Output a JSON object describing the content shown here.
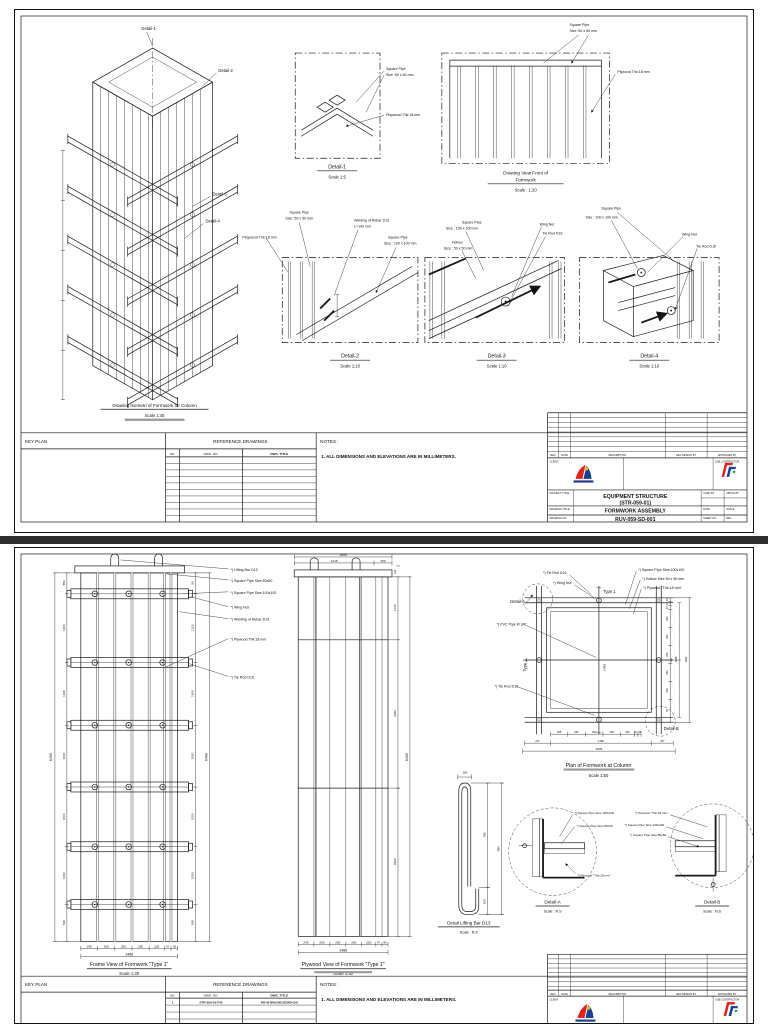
{
  "colors": {
    "red": "#e2231a",
    "blue": "#1b3f94",
    "yellow": "#f5c400",
    "green": "#00a650"
  },
  "s1": {
    "iso": {
      "c1": "Detail-1",
      "c2": "Detail-2",
      "c3": "Detail-3",
      "c4": "Detail-4",
      "cap": "Drawing Isometri of Formwork for Column",
      "scale": "Scale 1:40"
    },
    "d1": {
      "l1": "Square Pipe",
      "l2": "Size :50 x 50 mm",
      "l3": "Playwood Thk:18 mm",
      "t": "Detail-1",
      "s": "Scale 1:5"
    },
    "fv": {
      "l1": "Square Pipe",
      "l2": "Size :50 x 50 mm",
      "l3": "Plywood Thk:18 mm",
      "t1": "Drawing View Front of",
      "t2": "Formwork",
      "s": "Scale : 1:20"
    },
    "d2": {
      "l1": "Square Pipe",
      "l2": "Size :50 x 50 mm",
      "l3": "Playwood Thk:18 mm",
      "l4": "Welding of Rebar D13",
      "l5": "L=100 mm",
      "l6": "Square Pipe",
      "l7": "Size : 100 x 100 mm",
      "t": "Detail-2",
      "s": "Scale 1:10"
    },
    "d3": {
      "l1": "Square Pipe",
      "l2": "Size : 100 x 100 mm",
      "l3": "Hollow",
      "l4": "Size : 50 x 50 mm",
      "l5": "Wing Nut",
      "l6": "Tie Rod D16",
      "t": "Detail-3",
      "s": "Scale 1:10"
    },
    "d4": {
      "l1": "Square Pipe",
      "l2": "Size : 100 x 100 mm",
      "l3": "Wing Nut",
      "l4": "Tie Rod D16",
      "t": "Detail-4",
      "s": "Scale 1:10"
    },
    "strip": {
      "key": "KEY PLAN",
      "ref": "REFERENCE DRAWINGS",
      "no": "NO.",
      "dno": "DWG. NO.",
      "dtitle": "DWG. TITLE",
      "notes": "NOTES :",
      "note1": "1. ALL DIMENSIONS AND ELEVATIONS ARE IN MILLIMETERS."
    },
    "tb": {
      "rev": "REV",
      "date": "DATE",
      "desc": "DESCRIPTION",
      "rdb": "REV DESIGN BY",
      "apb": "APPROVED BY",
      "client": "CLIENT",
      "sub": "SUB CONTRACTOR",
      "ptl": "PROJECT TITLE",
      "pt1": "EQUIPMENT STRUCTURE",
      "pt2": "(STR-059-01)",
      "dtl": "DRAWING TITLE",
      "dt": "FORMWORK ASSEMBLY",
      "dnl": "DRAWING NO",
      "dn": "RUV-059-SD-001",
      "chk": "CHKD BY",
      "app": "APPVD BY",
      "datel": "DATE",
      "scl": "SCALE",
      "shl": "SHEET NO",
      "revl": "REV"
    }
  },
  "s2": {
    "lab": {
      "a": "*) Lifting Bar D13",
      "b": "*) Square Pipe Size:50x50",
      "c": "*) Square Pipe Size:100x100",
      "d": "*) Wing Nut",
      "e": "*) Welding of Rebar D13",
      "f": "*) Plywood Thk:18 mm",
      "g": "*) Tie Rod D16"
    },
    "fr": {
      "cap": "Frame View of Formwork \"Type 1\"",
      "s": "Scale 1:30",
      "bt": "1488",
      "lt": "6400",
      "rt": "6400",
      "bd": [
        "245",
        "250",
        "250",
        "250",
        "220",
        "97",
        "96"
      ],
      "ld": [
        "550",
        "1200",
        "1000",
        "1000",
        "1000",
        "1000",
        "500"
      ],
      "rd": [
        "90",
        "1100",
        "1000",
        "1000",
        "1000",
        "1000",
        "500"
      ]
    },
    "pw": {
      "cap": "Plywood View of Formwork \"Type 1\"",
      "s": "Scale 1:30",
      "tt": "1500",
      "td1": "1225",
      "td2": "250",
      "tsm": "140",
      "rt": "6400",
      "bt": "1488",
      "rd": [
        "1120",
        "2640",
        "2640"
      ],
      "bd": [
        "245",
        "250",
        "250",
        "250",
        "220",
        "97",
        "96"
      ]
    },
    "pl": {
      "cap": "Plan of Formwork at Column",
      "s": "Scale 1:50",
      "tie": "*) Tie Rod D16",
      "wing": "*) Wing Nut",
      "t1": "Type 1",
      "pipe": "*) Square Pipe Size:100x100",
      "hol": "*) Hollow Size 50 x 50 mm",
      "ply": "*) Plywood \"Thk:18 mm\"",
      "da": "Detail-A",
      "pvc": "*) PVC  Pipe Ø 3/4\"",
      "t2": "Type 2",
      "tie2": "*) Tie Rod D16",
      "db": "Detail-B",
      "bt": "2005",
      "rt1": "1488",
      "rt2": "1962",
      "inner": "1488",
      "bd": [
        "245",
        "250",
        "250",
        "250",
        "202",
        "45",
        "45"
      ],
      "b2": [
        "237",
        "1488",
        "237"
      ],
      "rd": [
        "50",
        "23",
        "23",
        "250",
        "250",
        "250",
        "250",
        "250",
        "50"
      ]
    },
    "lb": {
      "cap": "Detail Lifting Bar D13",
      "s": "Scale : N.S",
      "top": "100",
      "d1": "780",
      "d2": "200",
      "dt": "980"
    },
    "da": {
      "cap": "Detail-A",
      "s": "Scale : N.S",
      "l1": "*) Square Pipe Size:100x100",
      "l2": "*) Square Pipe Size:50x50",
      "l3": "*) Plywood \"Thk:18 mm\""
    },
    "db": {
      "cap": "Detail-B",
      "s": "Scale : N.S",
      "l1": "*) Plywood \"Thk:18 mm\"",
      "l2": "*) Square Pipe Size:100x100",
      "l3": "*) Square Pipe Size:50x50"
    },
    "strip": {
      "key": "KEY PLAN",
      "ref": "REFERENCE DRAWINGS",
      "no": "NO.",
      "dno": "DWG. NO.",
      "dtitle": "DWG. TITLE",
      "notes": "NOTES :",
      "note1": "1. ALL DIMENSIONS AND ELEVATIONS ARE IN MILLIMETERS.",
      "r1no": "1",
      "r1dno": "STR-059-01-F03",
      "r1dt": "P06 46 BRACING DESIGN (24)"
    },
    "tb": {
      "rev": "REV",
      "date": "DATE",
      "desc": "DESCRIPTION",
      "rdb": "REV DESIGN BY",
      "apb": "APPROVED BY",
      "client": "CLIENT",
      "sub": "SUB CONTRACTOR"
    }
  }
}
